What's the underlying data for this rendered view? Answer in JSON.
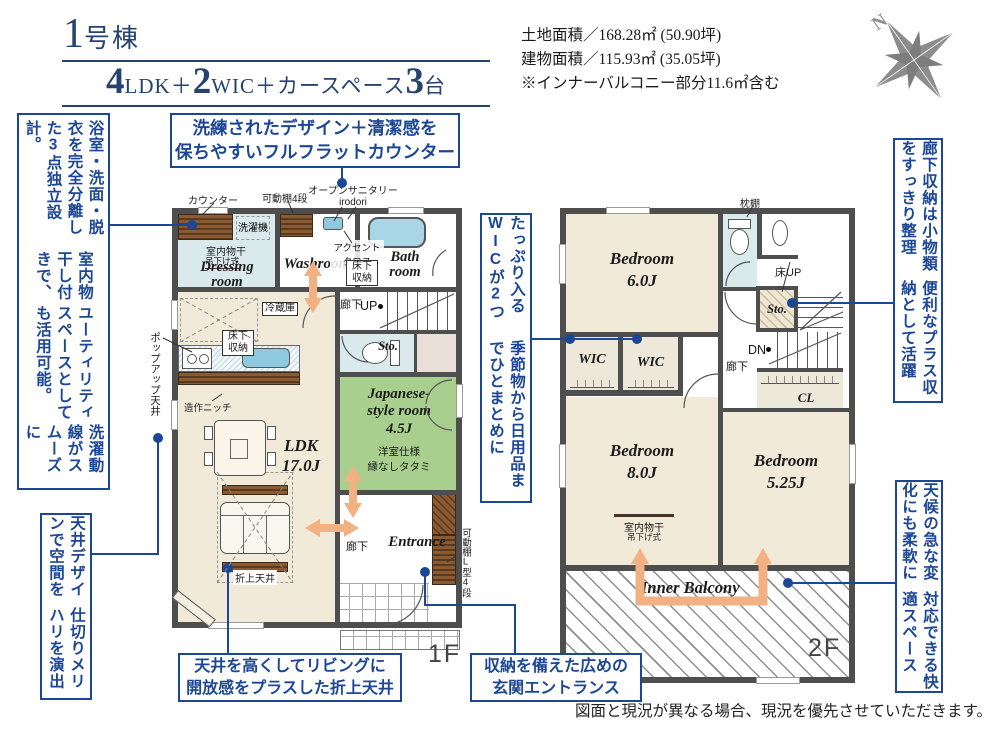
{
  "colors": {
    "accent_navy": "#1c4796",
    "title_navy": "#26436f",
    "wall_gray": "#4e4e4e",
    "floor_beige": "#f2ead9",
    "tatami_green": "#a9cf8e",
    "water_blue": "#d9e9ec",
    "wood_brown": "#7a4f2c",
    "arrow_orange": "#f1b183",
    "compass_gray": "#8d8d8d"
  },
  "header": {
    "building_no_parts": [
      "1",
      "号棟"
    ],
    "layout_parts": [
      "4",
      "LDK＋",
      "2",
      "WIC＋カースペース",
      "3",
      "台"
    ],
    "land_area": "土地面積／168.28㎡ (50.90坪)",
    "building_area": "建物面積／115.93㎡ (35.05坪)",
    "area_note": "※インナーバルコニー部分11.6㎡含む",
    "compass_north": "N"
  },
  "callouts": {
    "flat_counter": [
      "洗練されたデザイン＋清潔感を",
      "保ちやすいフルフラットカウンター"
    ],
    "separate_bath": [
      "浴室・洗面・脱衣を完全分離した3点独立設計。",
      "室内物干し付きで、",
      "ユーティリティスペースとしても活用可能。",
      "洗濯動線がスムーズに"
    ],
    "ceiling_zoning": [
      "天井デザインで空間を",
      "仕切りメリハリを演出"
    ],
    "two_wic": [
      "たっぷり入るWICが2つ",
      "季節物から日用品までひとまとめに"
    ],
    "genkan_storage": [
      "収納を備えた広めの",
      "玄関エントランス"
    ],
    "coffered_ceiling": [
      "天井を高くしてリビングに",
      "開放感をプラスした折上天井"
    ],
    "hall_storage": [
      "廊下収納は小物類をすっきり整理",
      "便利なプラス収納として活躍"
    ],
    "inner_balcony": [
      "天候の急な変化にも柔軟に",
      "対応できる快適スペース"
    ]
  },
  "floor1": {
    "floor_label": "1F",
    "counter": "カウンター",
    "shelf_4": "可動棚4段",
    "open_sanitary": [
      "オープンサニタリー",
      "irodori"
    ],
    "washer": "洗濯機",
    "indoor_drying": "室内物干",
    "hanging": "吊下け式",
    "dressing_room": [
      "Dressing",
      "room"
    ],
    "washroom": "Washroom",
    "accent_cloth": [
      "アクセント",
      "クロス"
    ],
    "underfloor_storage": [
      "床下",
      "収納"
    ],
    "bath_room": [
      "Bath",
      "room"
    ],
    "corridor": "廊下",
    "up": "UP",
    "storage": "Sto.",
    "japanese_room": [
      "Japanese-",
      "style room",
      "4.5J"
    ],
    "tatami_note": [
      "洋室仕様",
      "縁なしタタミ"
    ],
    "fridge": "冷蔵庫",
    "ldk": [
      "LDK",
      "17.0J"
    ],
    "niche": "造作ニッチ",
    "popup_ceiling": "ポップアップ天井",
    "coffered_label": "折上天井",
    "entrance": "Entrance",
    "corridor2": "廊下",
    "shelf_l4": "可動棚L型4段"
  },
  "floor2": {
    "floor_label": "2F",
    "pillow_shelf": "枕棚",
    "bedroom6": [
      "Bedroom",
      "6.0J"
    ],
    "floor_up": "床UP",
    "storage": "Sto.",
    "down": "DN",
    "corridor": "廊下",
    "wic1": "WIC",
    "wic2": "WIC",
    "closet": "CL",
    "bedroom8": [
      "Bedroom",
      "8.0J"
    ],
    "indoor_drying": "室内物干",
    "hanging": "吊下げ式",
    "bedroom525": [
      "Bedroom",
      "5.25J"
    ],
    "inner_balcony": "Inner Balcony"
  },
  "footer": {
    "disclaimer": "図面と現況が異なる場合、現況を優先させていただきます。"
  }
}
